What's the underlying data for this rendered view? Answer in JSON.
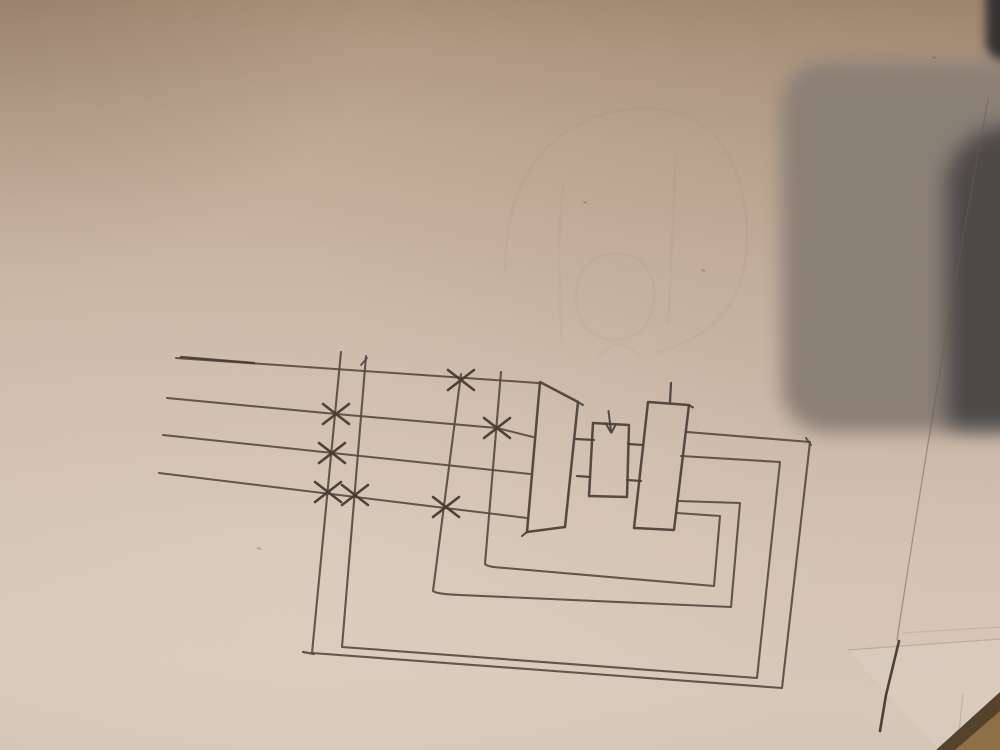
{
  "scene": {
    "description": "Photograph of a pencil hand-drawn electrical schematic on paper: four supply lines with X-marked fuse taps feeding a trapezoid device, two meter boxes (down-arrow mark, tick mark), and four nested return loops; dark object with shadow top-right, wooden table corner bottom-right",
    "text_content": ""
  },
  "palette": {
    "paper_mid": "#cfbcac",
    "pencil": "#564b43",
    "pencil_dark": "#453b33",
    "device_stroke": "#4c423a",
    "shadow_gray": "#8b8077",
    "object_dark": "#4d4949",
    "object_darker": "#343132",
    "wood_dark": "#55422a",
    "wood_light": "#8f7045",
    "hair_line": "#6e5b49"
  },
  "sketch": {
    "groups": {
      "undersheet": {
        "w": 1,
        "o": 1,
        "color": "#8d7a66",
        "paths": [
          {
            "d": "M848,650 L1000,638 L1000,750 L938,750 Z",
            "f": "rgba(232,221,209,0.20)"
          }
        ]
      },
      "ghost": {
        "color": "#86705c",
        "w": 2.6,
        "o": 0.055,
        "paths": [
          {
            "d": "M505,268 Q508,132 622,110 Q733,94 747,222 Q753,328 657,352"
          },
          {
            "d": "M562,342 Q556,240 563,186"
          },
          {
            "d": "M676,152 Q672,250 668,324"
          },
          {
            "d": "M576,300 Q576,256 616,253 Q656,256 654,299 Q651,338 614,340 Q579,337 576,300"
          },
          {
            "d": "M598,358 Q617,332 641,357",
            "o": 0.05
          }
        ]
      },
      "creases": {
        "color": "#8d7a66",
        "w": 1.3,
        "o": 0.35,
        "paths": [
          {
            "d": "M988,100 Q938,370 897,640",
            "c": "#6e5b49",
            "o": 0.5
          },
          {
            "d": "M848,650 L1000,639"
          },
          {
            "d": "M903,633 L1000,627",
            "o": 0.2
          },
          {
            "d": "M963,694 L957,750",
            "o": 0.3
          }
        ]
      },
      "bus_lines": {
        "color": "#564b43",
        "w": 2,
        "o": 0.92,
        "paths": [
          {
            "d": "M176,358 L538,383"
          },
          {
            "d": "M181,357 L254,363",
            "c": "#453b33",
            "w": 2.3
          },
          {
            "d": "M167,398 L336,414 L497,428 L533,437"
          },
          {
            "d": "M163,435 L530,474"
          },
          {
            "d": "M159,473 L527,518"
          }
        ]
      },
      "tap_loops": {
        "color": "#564b43",
        "w": 2.1,
        "o": 0.92,
        "paths": [
          {
            "d": "M341,352 L312,653 L782,688 L810,442 L687,432"
          },
          {
            "d": "M366,356 L342,647 L757,678 L780,462 L681,456"
          },
          {
            "d": "M461,374 L433,591 Q436,594 460,595 L731,607 L740,503 L679,501"
          },
          {
            "d": "M501,372 L485,564 Q487,567 505,568 L714,586 L720,516 L677,513"
          },
          {
            "d": "M303,652 L314,654",
            "w": 2.2
          },
          {
            "d": "M367,358 L361,365",
            "w": 1.9
          },
          {
            "d": "M806,438 L811,445",
            "w": 2
          }
        ]
      },
      "connectors": {
        "color": "#4c423a",
        "w": 2.2,
        "o": 0.95,
        "paths": [
          {
            "d": "M576,439 L594,440"
          },
          {
            "d": "M577,476 L590,477"
          },
          {
            "d": "M628,444 L643,445"
          },
          {
            "d": "M627,480 L641,481"
          }
        ]
      },
      "devices": {
        "color": "#4c423a",
        "w": 2.5,
        "o": 0.95,
        "paths": [
          {
            "d": "M540,382 L578,402 L565,527 L527,532 Z"
          },
          {
            "d": "M593,423 L629,425 L627,497 L589,496 Z"
          },
          {
            "d": "M648,402 L689,405 L674,530 L634,528 Z"
          },
          {
            "d": "M671,383 L670,402",
            "w": 2.3
          },
          {
            "d": "M608.5,411 L611,431",
            "w": 2
          },
          {
            "d": "M605.5,423 L611,432.5",
            "w": 2
          },
          {
            "d": "M616,424 L611.5,432.5",
            "w": 2
          },
          {
            "d": "M578,402 L583,405",
            "w": 2
          },
          {
            "d": "M689,405 L693,407.5",
            "w": 2
          },
          {
            "d": "M527,532 L522,536",
            "w": 2
          }
        ]
      },
      "x_marks": {
        "color": "#453b33",
        "w": 2.6,
        "o": 0.95,
        "paths": [
          {
            "d": "M448,370 L474,390"
          },
          {
            "d": "M448,390 L474,370"
          },
          {
            "d": "M323,404 L349,424"
          },
          {
            "d": "M323,424 L349,404"
          },
          {
            "d": "M484,418 L510,438"
          },
          {
            "d": "M484,438 L510,418"
          },
          {
            "d": "M319,443 L345,463"
          },
          {
            "d": "M319,463 L345,443"
          },
          {
            "d": "M315,482 L341,502"
          },
          {
            "d": "M315,502 L341,482"
          },
          {
            "d": "M342,485 L368,505"
          },
          {
            "d": "M342,505 L368,485"
          },
          {
            "d": "M433,497 L459,517"
          },
          {
            "d": "M433,517 L459,497"
          }
        ]
      },
      "specks": {
        "color": "#6b5a4a",
        "w": 2,
        "o": 0.35,
        "paths": [
          {
            "d": "M258,548 l2,1"
          },
          {
            "d": "M584,202 l2,1"
          },
          {
            "d": "M702,270 l2,1"
          },
          {
            "d": "M933,57 l2,1"
          }
        ]
      },
      "pencil_scratch": {
        "color": "#3a322b",
        "w": 2.6,
        "o": 0.9,
        "paths": [
          {
            "d": "M899,641 L886,695 L880,731"
          }
        ]
      },
      "wood_corner": {
        "w": 1,
        "o": 1,
        "color": "#55422a",
        "paths": [
          {
            "d": "M936,750 L1000,692 L1000,750 Z",
            "f": "#55422a"
          },
          {
            "d": "M955,750 L1000,711 L1000,750 Z",
            "f": "#8f7045"
          }
        ]
      }
    }
  }
}
